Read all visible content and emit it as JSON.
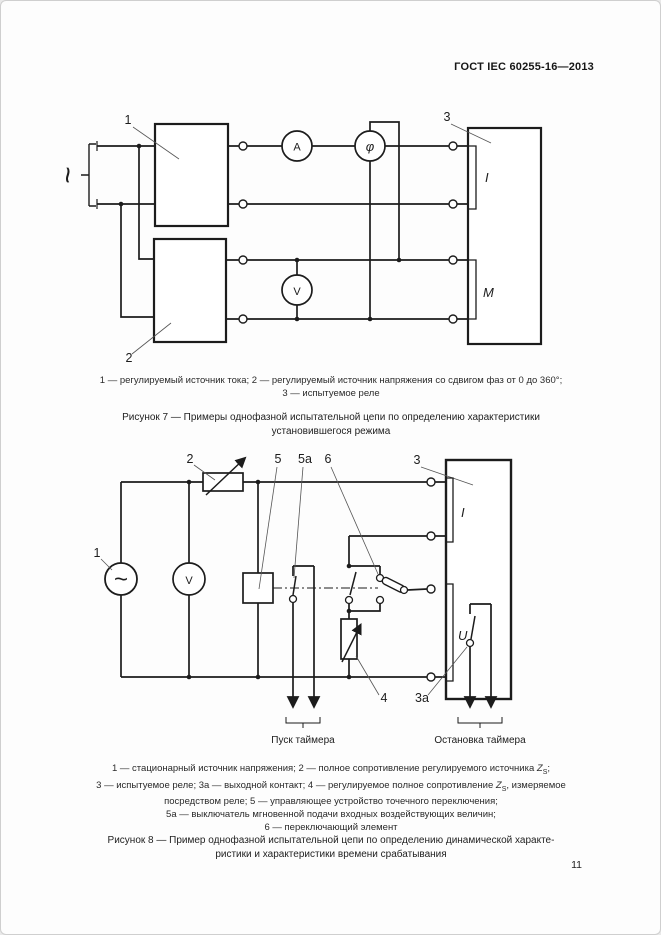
{
  "page": {
    "header": "ГОСТ IEC 60255-16—2013",
    "number": "11"
  },
  "fig7": {
    "ac": "~",
    "n1": "1",
    "n2": "2",
    "n3": "3",
    "ammeter": "A",
    "phase": "φ",
    "voltmeter": "V",
    "bracket_current": "I",
    "bracket_m": "M",
    "cap1": "1 — регулируемый источник тока; 2 — регулируемый источник напряжения со сдвигом фаз от 0 до 360°;",
    "cap2": "3 — испытуемое реле",
    "title1": "Рисунок 7 — Примеры однофазной испытательной цепи по определению характеристики",
    "title2": "установившегося режима"
  },
  "fig8": {
    "ac": "~",
    "n1": "1",
    "n2": "2",
    "n3": "3",
    "n3a": "3а",
    "n4": "4",
    "n5": "5",
    "n5a": "5а",
    "n6": "6",
    "voltmeter": "V",
    "bracket_current": "I",
    "bracket_voltage": "U",
    "timer_start": "Пуск таймера",
    "timer_stop": "Остановка таймера",
    "cap1a": "1 — стационарный источник напряжения; 2 — полное сопротивление регулируемого источника ",
    "z": "Z",
    "zsub": "S",
    "cap1b": ";",
    "cap2a": "3 — испытуемое реле; 3а — выходной контакт; 4 — регулируемое полное сопротивление ",
    "cap2b": ", измеряемое",
    "cap3": "посредством реле; 5 — управляющее устройство точечного переключения;",
    "cap4": "5а — выключатель мгновенной подачи входных воздействующих величин;",
    "cap5": "6 — переключающий элемент",
    "title1": "Рисунок 8 — Пример однофазной испытательной цепи по определению динамической характе-",
    "title2": "ристики и характеристики времени срабатывания"
  }
}
